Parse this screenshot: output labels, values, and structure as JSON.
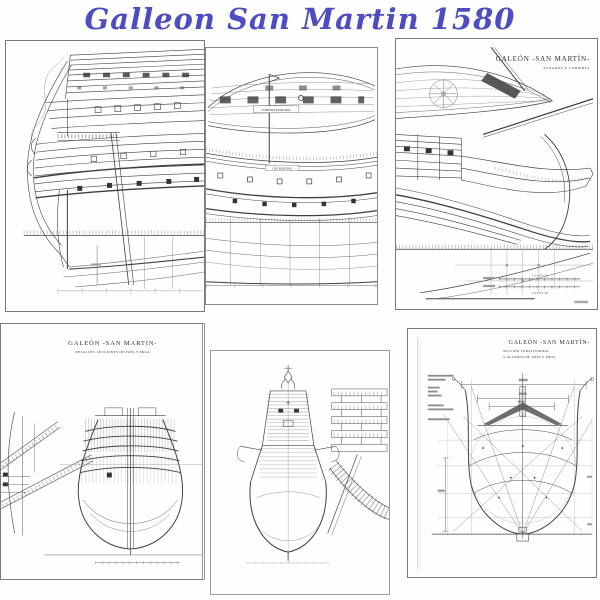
{
  "title": "Galleon San Martin 1580",
  "title_color": "#4d4cc0",
  "ink_color": "#3f3f3f",
  "panels": {
    "top_middle": {
      "deck_label": "CUBIERTA PRINCIPAL",
      "elev_label": "CUB. PRINCIPAL"
    },
    "top_right": {
      "title": "GALEÓN -SAN MARTÍN-",
      "subtitle": "ALZADOS Y CUBIERTA",
      "scale_numbers": "1 2 3 4 5 10"
    },
    "bottom_left": {
      "title": "GALEÓN -SAN MARTÍN-",
      "subtitle": "DETALLES. SECCIONES DE POPA Y PROA"
    },
    "bottom_right": {
      "title": "GALEÓN -SAN MARTÍN-",
      "subtitle1": "SECCIÓN LONGITUDINAL",
      "subtitle2": "Y ALZADOS DE POPA Y PROA"
    }
  }
}
